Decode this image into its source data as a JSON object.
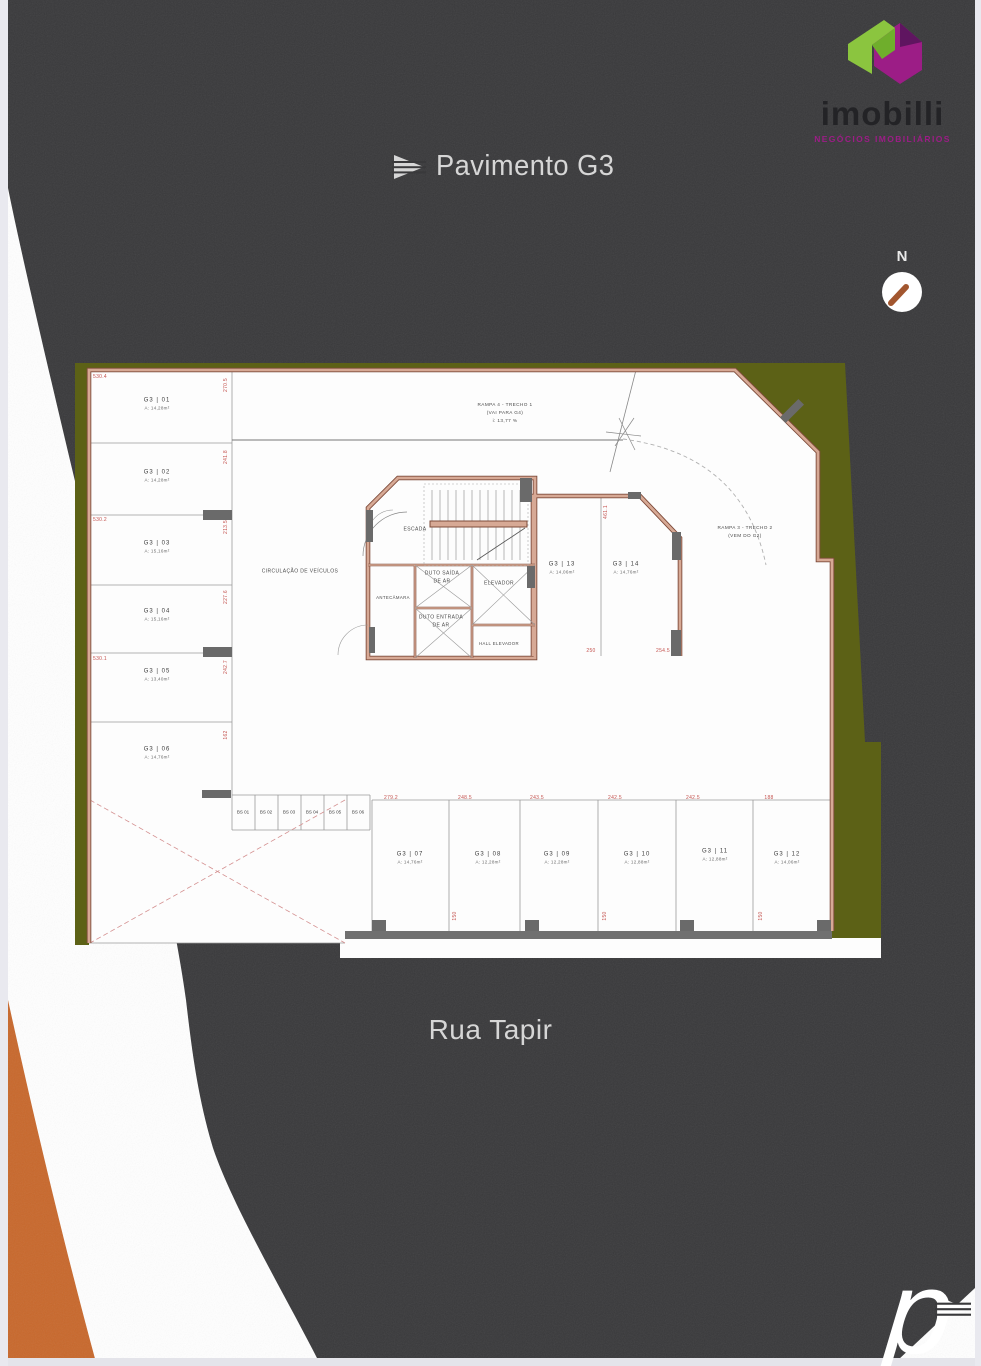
{
  "header": {
    "logo": {
      "name": "imobilli",
      "tagline": "NEGÓCIOS IMOBILIÁRIOS"
    },
    "title": "Pavimento G3",
    "compass_label": "N"
  },
  "street_label": "Rua Tapir",
  "colors": {
    "background_charcoal": "#39393b",
    "accent_orange": "#c8682c",
    "lot_green": "#5c6116",
    "wall_salmon": "#d7a995",
    "dimension_red": "#c4524e",
    "brand_magenta": "#9c1d86",
    "brand_green": "#8bc53f"
  },
  "plan": {
    "rooms": {
      "circulation": "CIRCULAÇÃO DE VEÍCULOS",
      "stairs": "ESCADA",
      "antechamber": "ANTECÂMARA",
      "air_out_1": "DUTO SAÍDA",
      "air_out_2": "DE AR",
      "air_in_1": "DUTO ENTRADA",
      "air_in_2": "DE AR",
      "elevator": "ELEVADOR",
      "elevator_hall": "HALL ELEVADOR"
    },
    "ramps": {
      "ramp4_line1": "RAMPA 4 - TRECHO 1",
      "ramp4_line2": "(VAI PARA G4)",
      "ramp4_slope": "i: 13,77 %",
      "ramp3_line1": "RAMPA 3 - TRECHO 2",
      "ramp3_line2": "(VEM DO G2)"
    },
    "stalls": [
      {
        "id": "G3 | 01",
        "area": "A: 14,28m²"
      },
      {
        "id": "G3 | 02",
        "area": "A: 14,28m²"
      },
      {
        "id": "G3 | 03",
        "area": "A: 15,16m²"
      },
      {
        "id": "G3 | 04",
        "area": "A: 15,16m²"
      },
      {
        "id": "G3 | 05",
        "area": "A: 13,40m²"
      },
      {
        "id": "G3 | 06",
        "area": "A: 14,76m²"
      },
      {
        "id": "G3 | 07",
        "area": "A: 14,76m²"
      },
      {
        "id": "G3 | 08",
        "area": "A: 12,28m²"
      },
      {
        "id": "G3 | 09",
        "area": "A: 12,28m²"
      },
      {
        "id": "G3 | 10",
        "area": "A: 12,88m²"
      },
      {
        "id": "G3 | 11",
        "area": "A: 12,88m²"
      },
      {
        "id": "G3 | 12",
        "area": "A: 14,06m²"
      },
      {
        "id": "G3 | 13",
        "area": "A: 14,06m²"
      },
      {
        "id": "G3 | 14",
        "area": "A: 14,76m²"
      }
    ],
    "bike_stalls": [
      "BS 01",
      "BS 02",
      "BS 03",
      "BS 04",
      "BS 05",
      "BS 06"
    ],
    "dims": {
      "left": [
        "530.4",
        "530.2",
        "530.1"
      ],
      "left_side": [
        "270.5",
        "241.8",
        "213.5",
        "227.6",
        "242.7",
        "162"
      ],
      "right_side": [
        "461.1"
      ],
      "stalls_13_14": [
        "250",
        "254.5"
      ],
      "bottom_row_top": [
        "279.2",
        "248.5",
        "243.5",
        "242.5",
        "242.5",
        "188"
      ],
      "bottom_row_inner": [
        "150",
        "150",
        "150"
      ]
    }
  }
}
